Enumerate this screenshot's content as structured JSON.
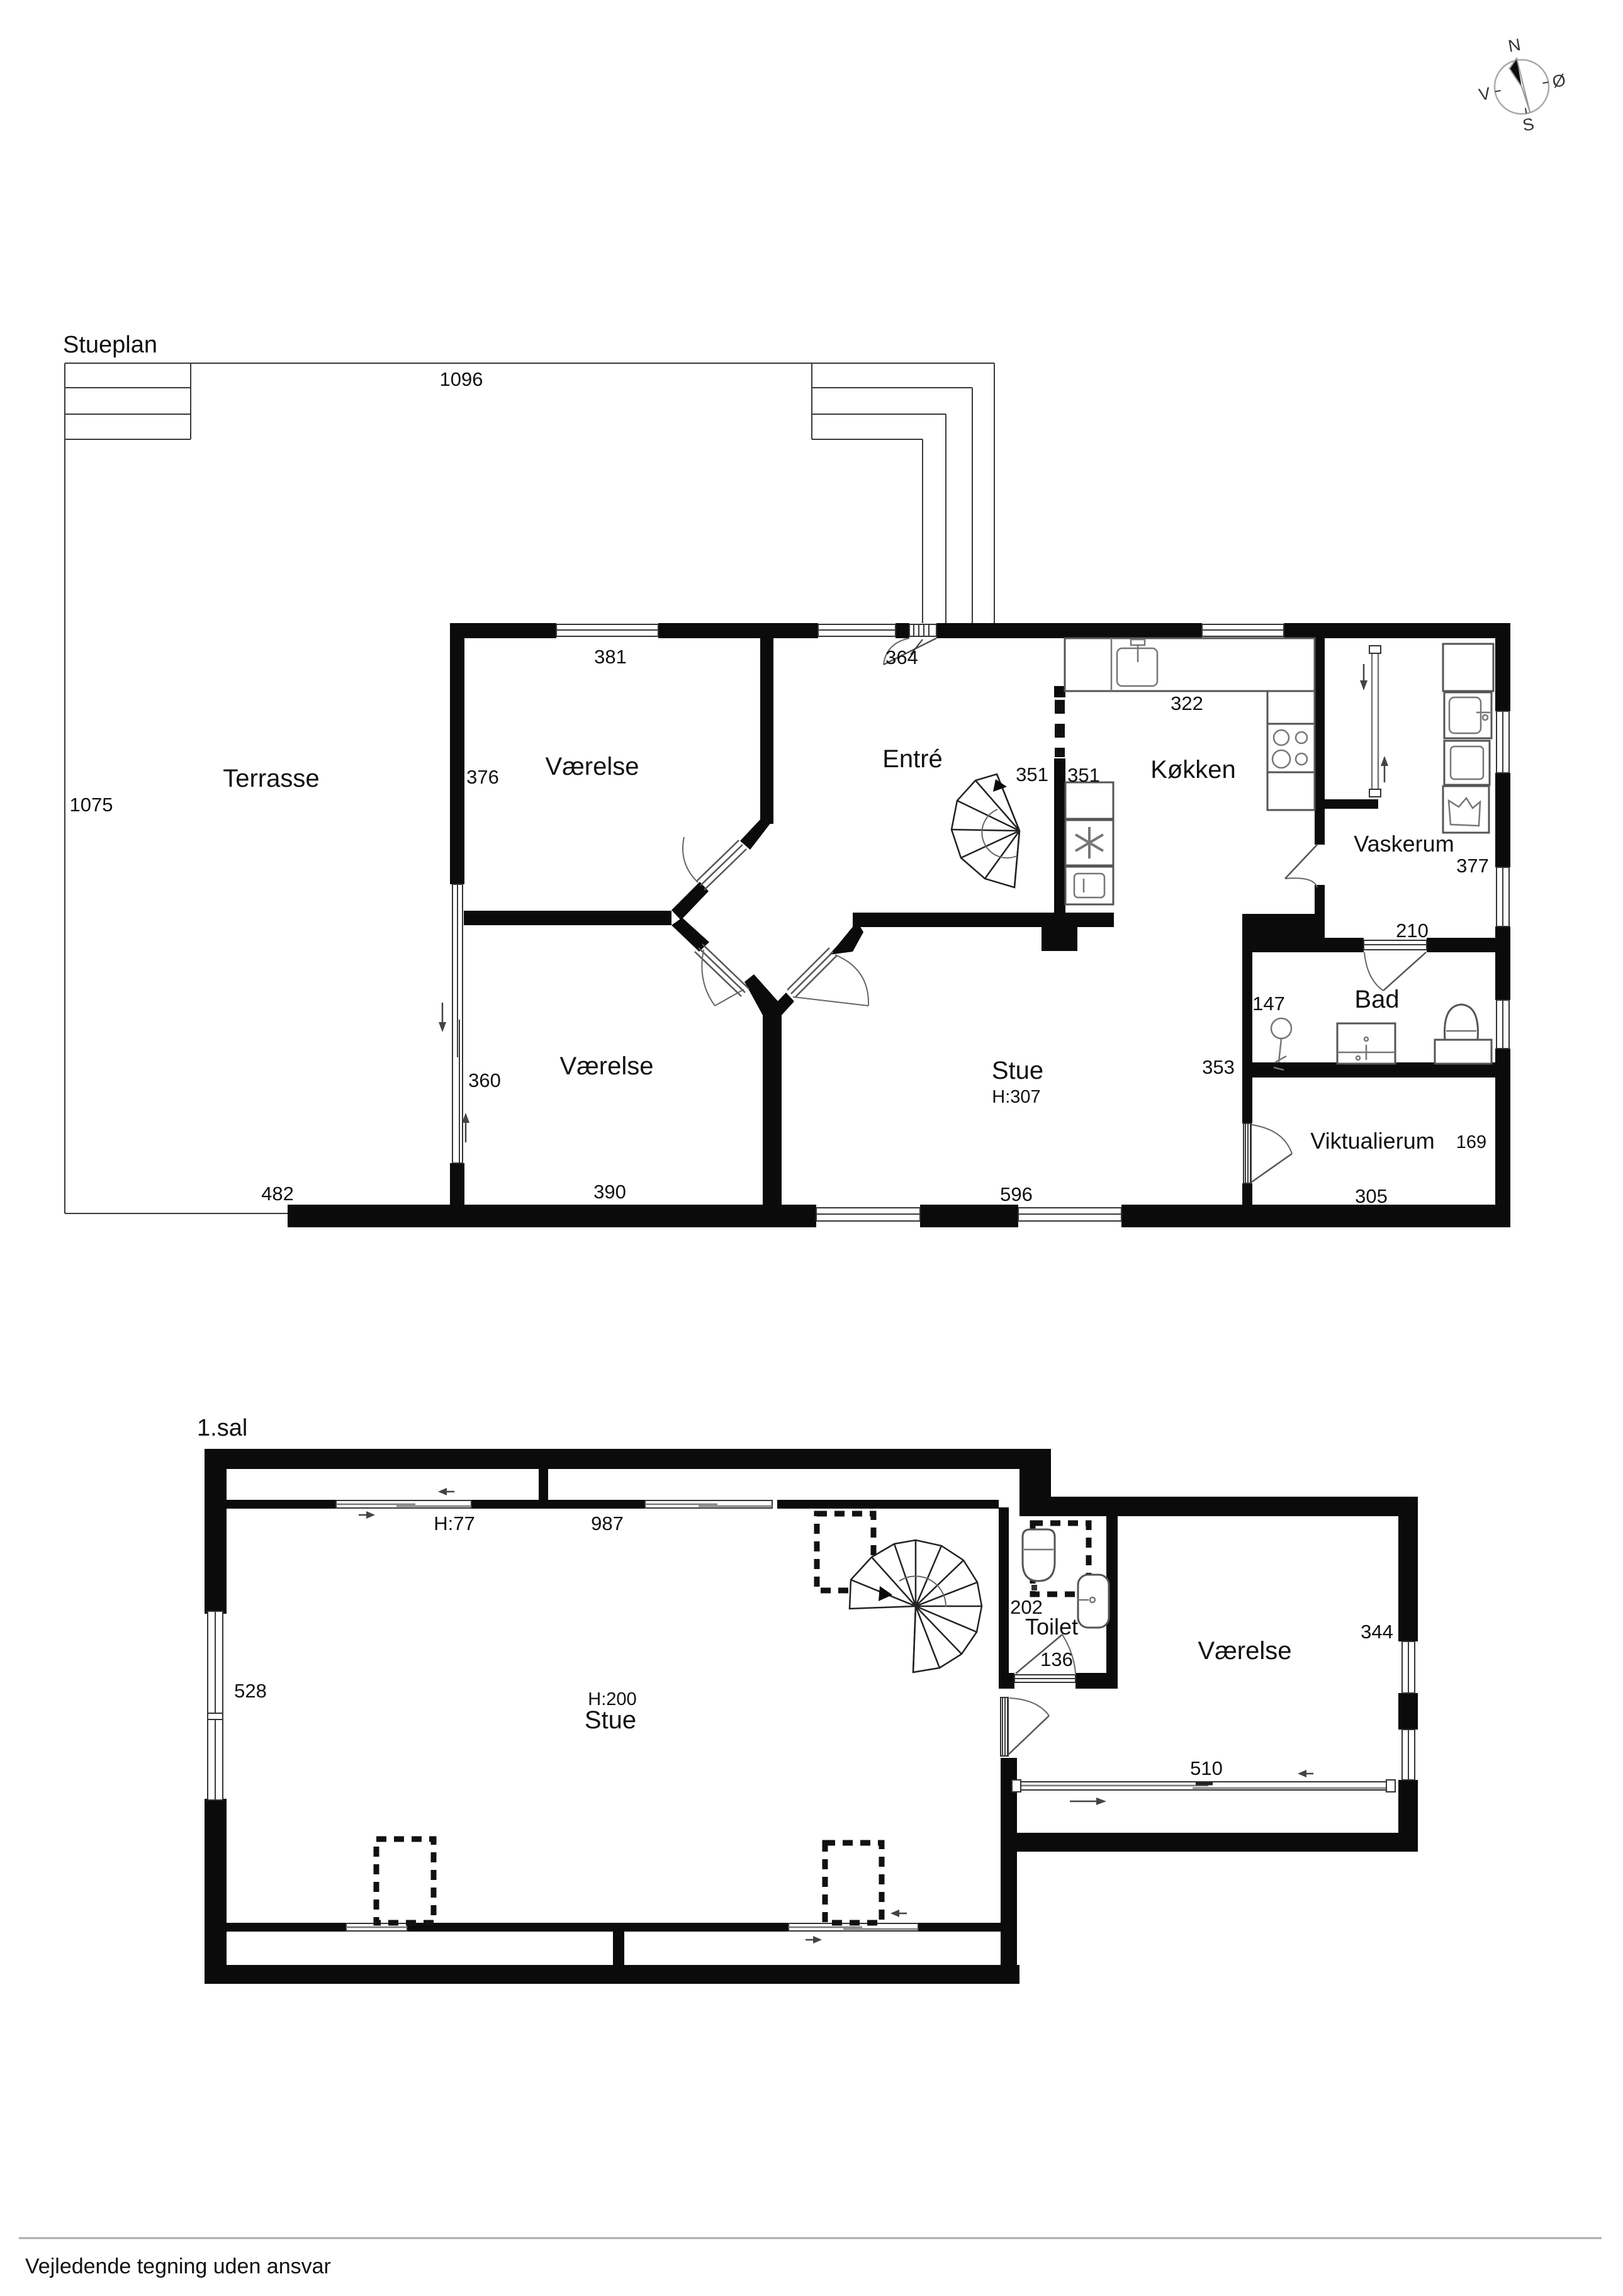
{
  "titles": {
    "ground": "Stueplan",
    "first": "1.sal"
  },
  "disclaimer": "Vejledende tegning uden ansvar",
  "compass": {
    "north": "N",
    "east": "Ø",
    "south": "S",
    "west": "V"
  },
  "gf": {
    "rooms": {
      "terrasse": "Terrasse",
      "bedroom_nw": "Værelse",
      "entre": "Entré",
      "kitchen": "Køkken",
      "utility": "Vaskerum",
      "bath": "Bad",
      "living": "Stue",
      "living_height": "H:307",
      "bedroom_sw": "Værelse",
      "pantry": "Viktualierum"
    },
    "dims": {
      "terrace_top": "1096",
      "terrace_left": "1075",
      "bedroom_nw_w": "381",
      "bedroom_nw_h": "376",
      "entry_door": "364",
      "hall_a": "351",
      "hall_b": "351",
      "kitchen_w": "322",
      "utility_h": "377",
      "utility_w": "210",
      "shower": "147",
      "hall_c": "353",
      "bedroom_sw_h": "360",
      "bedroom_sw_w": "390",
      "terrace_s": "482",
      "living_s": "596",
      "pantry_w": "305",
      "pantry_h": "169"
    }
  },
  "ff": {
    "rooms": {
      "living": "Stue",
      "living_height": "H:200",
      "toilet": "Toilet",
      "bedroom": "Værelse"
    },
    "dims": {
      "knee_height": "H:77",
      "top_w": "987",
      "left_h": "528",
      "toilet_w": "202",
      "toilet_d": "136",
      "bedroom_h": "344",
      "bedroom_s": "510"
    }
  }
}
